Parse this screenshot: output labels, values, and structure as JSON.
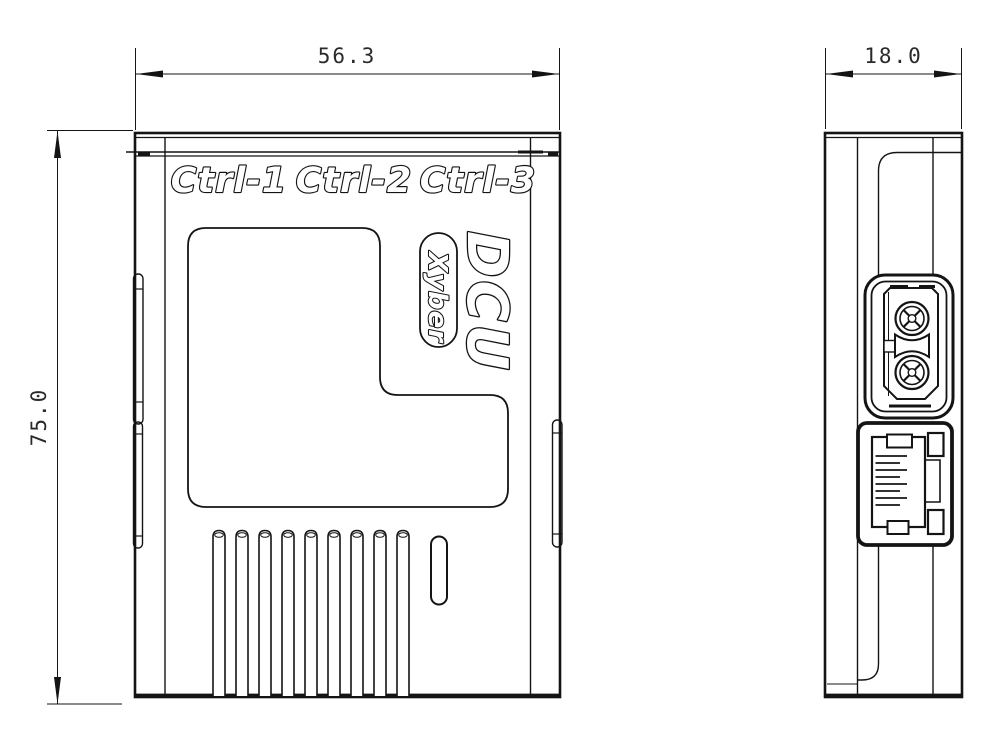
{
  "drawing": {
    "type": "technical-drawing",
    "background_color": "#ffffff",
    "line_color": "#141414",
    "front_view": {
      "label": "front view",
      "width_dimension": "56.3",
      "height_dimension": "75.0",
      "port_labels": [
        "Ctrl-1",
        "Ctrl-2",
        "Ctrl-3"
      ],
      "product_name": "DCU",
      "brand_name": "Xyber",
      "vent_slot_count": 9
    },
    "side_view": {
      "label": "side view",
      "depth_dimension": "18.0",
      "ethernet_contact_count": 8
    }
  }
}
